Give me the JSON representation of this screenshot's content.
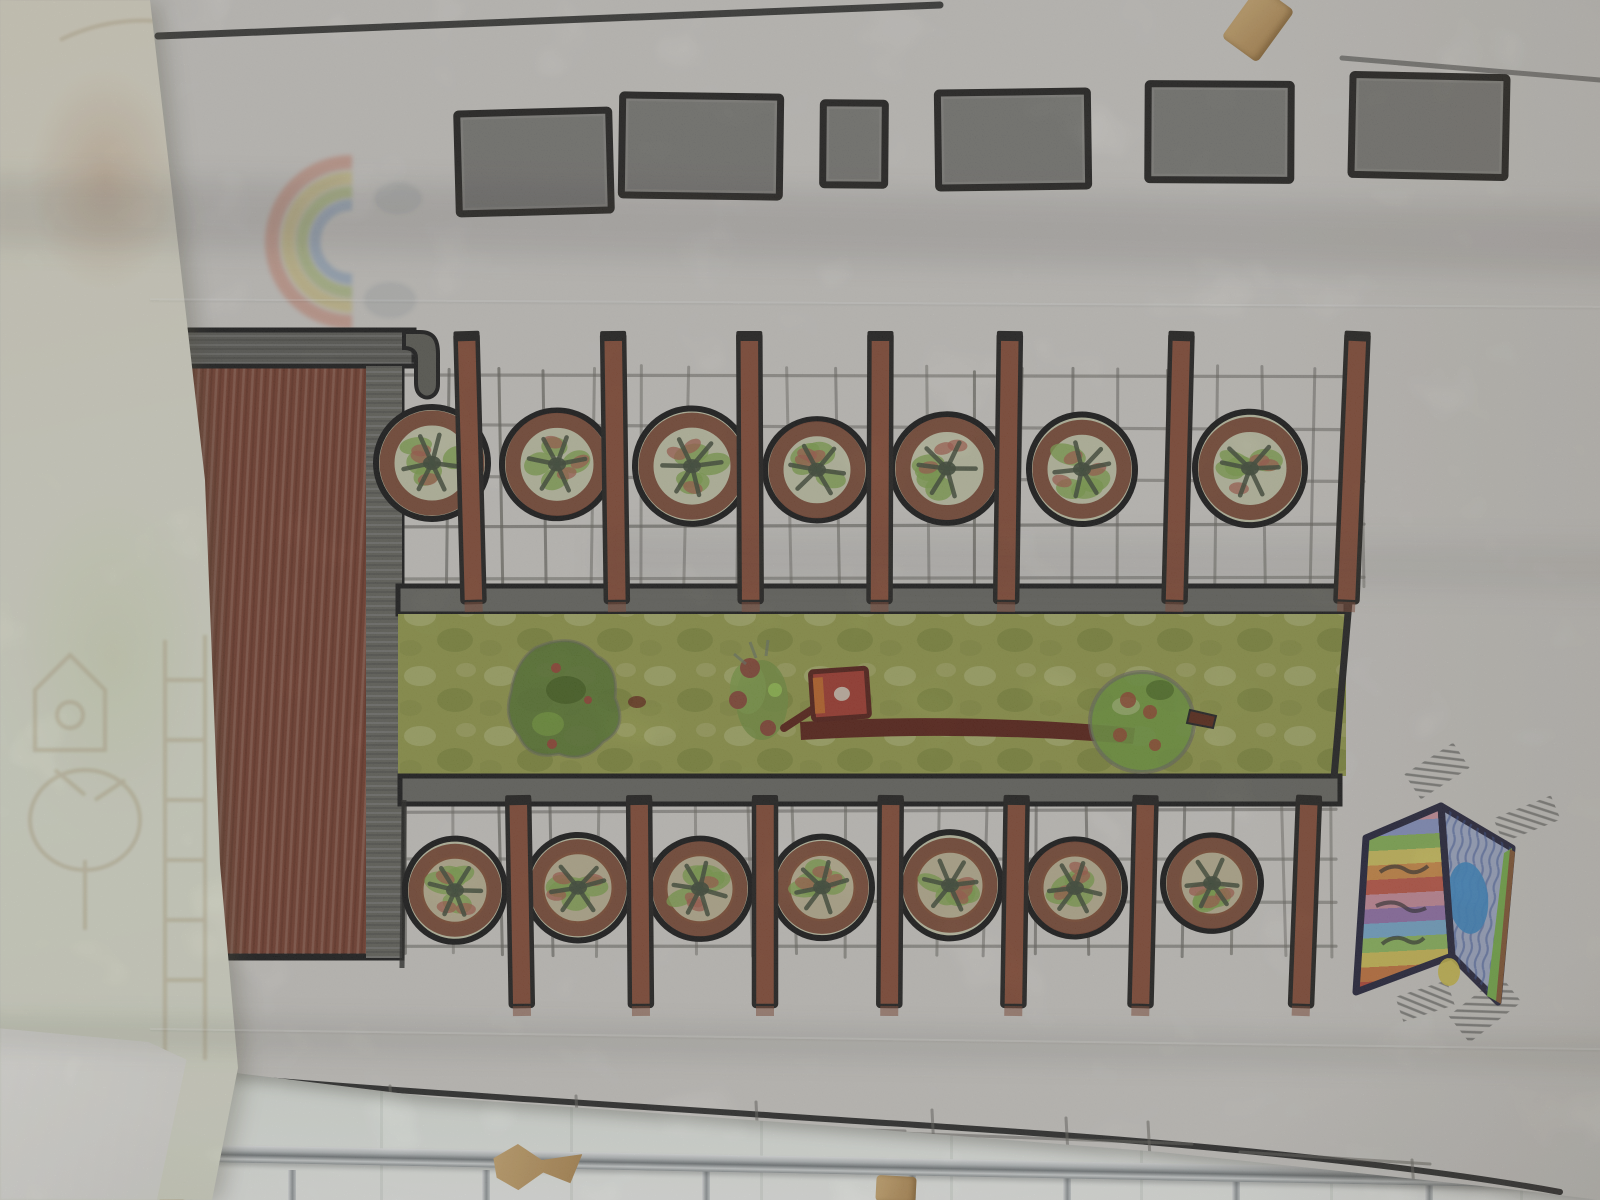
{
  "scene": {
    "description": "Photograph of a child's hand-drawn site plan in crayon, colored pencil and marker on translucent tracing paper, hung above a chrome railing with wooden clothespins; a second pale sketch sheet overlaps the left edge and a faint rainbow drawing shows through the paper",
    "visible_text": "none"
  },
  "palette": {
    "paper": "#d7d5d0",
    "marker": "#23221f",
    "graphite": "#8c8b86",
    "pencil": "#6f6d66",
    "building_brown": "#7c4231",
    "band_gray": "#6d6d66",
    "post_brown": "#8d4f38",
    "tree_ring": "#7d4834",
    "tree_inner": "#ccceb0",
    "tree_green": "#87ad52",
    "tree_red": "#ad6150",
    "tree_core": "#44503c",
    "lawn": "#9aa14e",
    "bush_dark": "#5d7c33",
    "log_brown": "#5e2317",
    "box_red": "#a83c30",
    "box_orange": "#c96a2a",
    "rail": "#c8cccd",
    "wood": "#c9a66b",
    "underlay": "#e8e6d6",
    "wall": "#f3f2ec"
  },
  "rect_row": {
    "label": "row of six graphite-shaded rectangles along the top",
    "items": [
      {
        "x": 458,
        "y": 112,
        "w": 152,
        "h": 100,
        "rot": -1.5
      },
      {
        "x": 622,
        "y": 96,
        "w": 158,
        "h": 100,
        "rot": 0.8
      },
      {
        "x": 823,
        "y": 103,
        "w": 62,
        "h": 82,
        "rot": 0.5
      },
      {
        "x": 938,
        "y": 92,
        "w": 150,
        "h": 95,
        "rot": -0.8
      },
      {
        "x": 1148,
        "y": 84,
        "w": 143,
        "h": 96,
        "rot": 0.3
      },
      {
        "x": 1352,
        "y": 76,
        "w": 154,
        "h": 100,
        "rot": 1.2
      }
    ]
  },
  "rainbow": {
    "label": "faint rainbow showing through the tracing paper",
    "cx": 352,
    "cy": 242,
    "radii": [
      80,
      64,
      50,
      37
    ],
    "widths": [
      14,
      13,
      12,
      11
    ],
    "colors": [
      "#d4836b",
      "#d6c366",
      "#a3b95c",
      "#7e9ec4"
    ],
    "cloud_color": "#98a0a6"
  },
  "grids": [
    {
      "x0": 402,
      "x1": 1360,
      "y0": 368,
      "y1": 588,
      "cols": 20,
      "rows": 5
    },
    {
      "x0": 404,
      "x1": 1332,
      "y0": 802,
      "y1": 956,
      "cols": 19,
      "rows": 4
    }
  ],
  "tree_rows": [
    {
      "y": 468,
      "items": [
        {
          "x": 432,
          "r": 56
        },
        {
          "x": 557,
          "r": 55
        },
        {
          "x": 692,
          "r": 57
        },
        {
          "x": 817,
          "r": 52
        },
        {
          "x": 947,
          "r": 55
        },
        {
          "x": 1082,
          "r": 53
        },
        {
          "x": 1250,
          "r": 55
        }
      ]
    },
    {
      "y": 888,
      "items": [
        {
          "x": 455,
          "r": 50
        },
        {
          "x": 578,
          "r": 52
        },
        {
          "x": 700,
          "r": 51
        },
        {
          "x": 822,
          "r": 50
        },
        {
          "x": 950,
          "r": 51
        },
        {
          "x": 1075,
          "r": 50
        },
        {
          "x": 1212,
          "r": 49
        }
      ]
    }
  ],
  "post_rows": [
    {
      "y0": 334,
      "y1": 602,
      "xs": [
        470,
        615,
        750,
        880,
        1008,
        1178,
        1352
      ],
      "tilts": [
        -1.5,
        -0.8,
        -0.3,
        0.2,
        0.8,
        1.5,
        2.4
      ]
    },
    {
      "y0": 798,
      "y1": 1006,
      "xs": [
        520,
        640,
        765,
        890,
        1015,
        1143,
        1305
      ],
      "tilts": [
        -1,
        -0.5,
        0,
        0.4,
        0.9,
        1.4,
        2.2
      ]
    }
  ],
  "mural": {
    "label": "open folded card with rainbow panel and blue pond panel, taped at corners",
    "stripe_colors": [
      "#d79aa8",
      "#8f9cd0",
      "#8cba58",
      "#d9cc62",
      "#d89148",
      "#c85a48",
      "#d494a4",
      "#9a76b4",
      "#7cb2d8",
      "#94c261",
      "#d9c85a",
      "#d07a40",
      "#bf4a38"
    ],
    "panel_blue": "#a9b6d4",
    "pond": "#3f8fd0",
    "green": "#7cb84c",
    "brown": "#8a5a34",
    "yellow": "#d8c84c",
    "outline": "#23233c"
  },
  "baseline": {
    "marks": [
      [
        186,
        1080,
        188,
        1112
      ],
      [
        390,
        1086,
        392,
        1120
      ],
      [
        576,
        1096,
        578,
        1136
      ],
      [
        756,
        1102,
        758,
        1142
      ],
      [
        932,
        1110,
        934,
        1150
      ],
      [
        1066,
        1118,
        1068,
        1154
      ],
      [
        1148,
        1122,
        1150,
        1158
      ],
      [
        1412,
        1160,
        1414,
        1190
      ],
      [
        168,
        1092,
        312,
        1098
      ],
      [
        378,
        1112,
        652,
        1119
      ],
      [
        460,
        1124,
        560,
        1128
      ],
      [
        872,
        1132,
        1192,
        1144
      ],
      [
        1240,
        1152,
        1430,
        1164
      ],
      [
        612,
        1124,
        905,
        1131
      ]
    ]
  },
  "railing": {
    "post_xs": [
      288,
      482,
      702,
      908,
      1063,
      1232,
      1425
    ]
  },
  "clothespins": [
    {
      "type": "top",
      "x": 1236,
      "y": -8,
      "w": 44,
      "h": 64,
      "rot": 36
    },
    {
      "type": "zig",
      "x": 492,
      "y": 1146,
      "w": 88,
      "h": 56,
      "rot": 6
    },
    {
      "type": "nub",
      "x": 876,
      "y": 1176,
      "w": 40,
      "h": 26,
      "rot": 3
    },
    {
      "type": "nub",
      "x": 156,
      "y": 1170,
      "w": 36,
      "h": 32,
      "rot": -18
    }
  ]
}
